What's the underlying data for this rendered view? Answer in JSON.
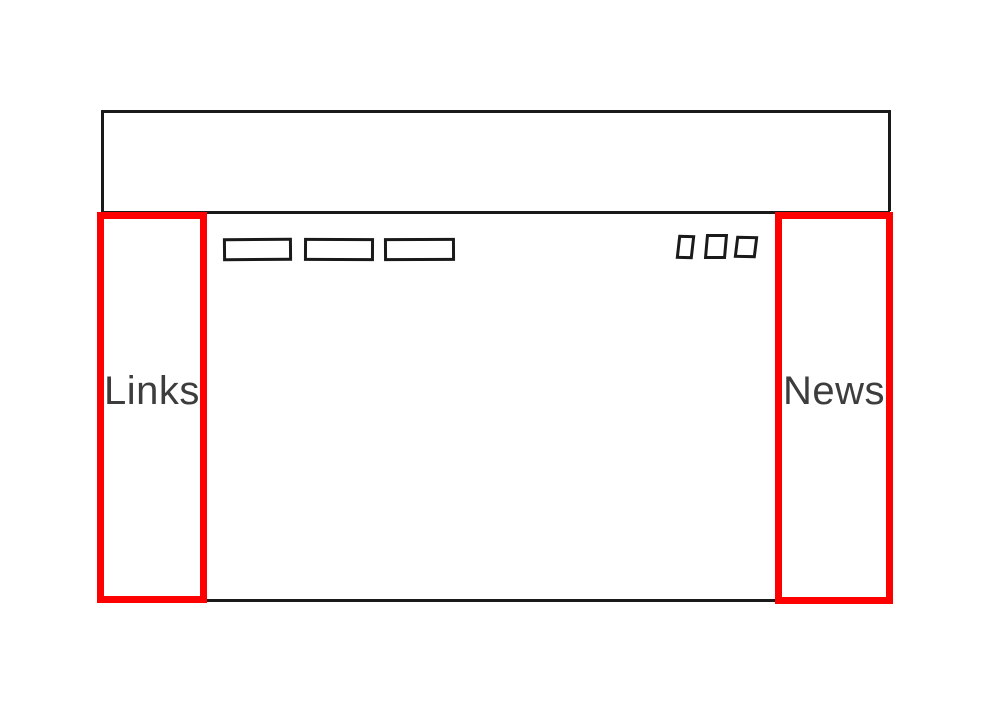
{
  "page": {
    "colors": {
      "background": "#ffffff",
      "stroke": "#1a1a1a",
      "highlight": "#ff0000",
      "label": "#3d3d3d"
    }
  },
  "wireframe": {
    "header": {
      "name": "header-box"
    },
    "content": {
      "name": "content-box"
    },
    "left_sidebar": {
      "label": "Links"
    },
    "right_sidebar": {
      "label": "News"
    },
    "nav_buttons": [
      {
        "name": "nav-button-1"
      },
      {
        "name": "nav-button-2"
      },
      {
        "name": "nav-button-3"
      }
    ],
    "small_buttons": [
      {
        "name": "small-button-1"
      },
      {
        "name": "small-button-2"
      },
      {
        "name": "small-button-3"
      }
    ]
  }
}
